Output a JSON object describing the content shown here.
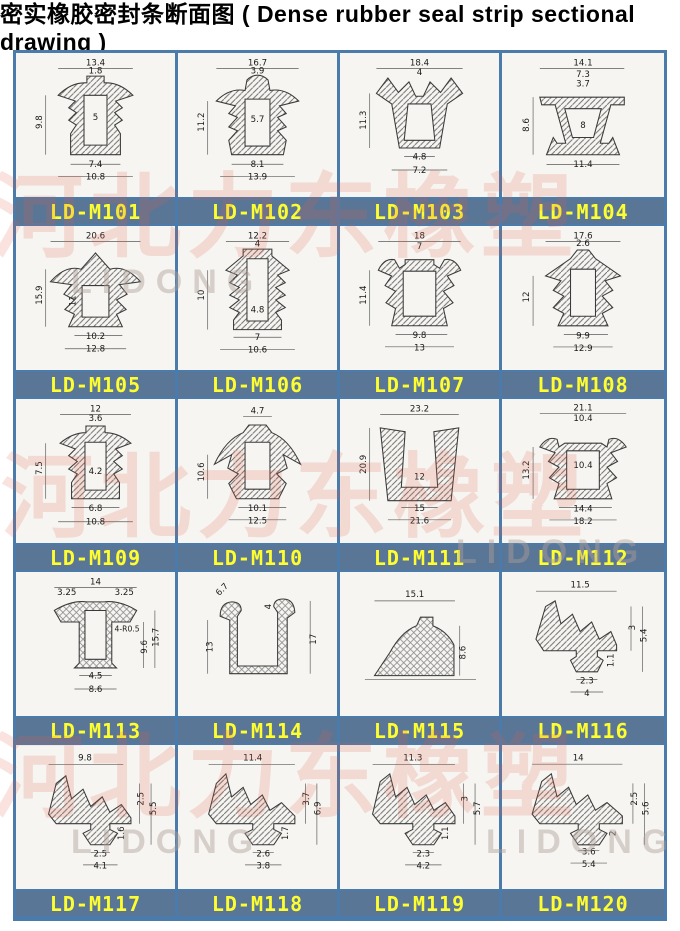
{
  "title": {
    "full": "密实橡胶密封条断面图 ( Dense rubber seal strip sectional drawing )",
    "zh": "密实橡胶密封条断面图",
    "en": "( Dense rubber seal strip sectional drawing )"
  },
  "watermark": {
    "zh": "河北力东橡塑",
    "en": "LIDONG"
  },
  "colors": {
    "table_border": "#4a7bab",
    "label_bar_bg": "#5a7696",
    "label_text": "#fdfd30",
    "paper": "#f6f5f1",
    "drawing_line": "#3a3a3a",
    "watermark_red": "rgba(228,94,74,0.18)"
  },
  "cells": [
    {
      "label": "LD-M101",
      "dims": [
        "13.4",
        "1.8",
        "9.8",
        "5",
        "7.4",
        "10.8"
      ]
    },
    {
      "label": "LD-M102",
      "dims": [
        "16.7",
        "3.9",
        "11.2",
        "5.7",
        "8.1",
        "13.9"
      ]
    },
    {
      "label": "LD-M103",
      "dims": [
        "18.4",
        "4",
        "11.3",
        "4.8",
        "7.2"
      ]
    },
    {
      "label": "LD-M104",
      "dims": [
        "14.1",
        "7.3",
        "3.7",
        "8.6",
        "8",
        "11.4"
      ]
    },
    {
      "label": "LD-M105",
      "dims": [
        "20.6",
        "15.9",
        "11",
        "10.2",
        "12.8"
      ]
    },
    {
      "label": "LD-M106",
      "dims": [
        "12.2",
        "4",
        "10",
        "4.8",
        "7",
        "10.6"
      ]
    },
    {
      "label": "LD-M107",
      "dims": [
        "18",
        "7",
        "11.4",
        "9.8",
        "13"
      ]
    },
    {
      "label": "LD-M108",
      "dims": [
        "17.6",
        "2.6",
        "12",
        "9.9",
        "12.9"
      ]
    },
    {
      "label": "LD-M109",
      "dims": [
        "12",
        "3.6",
        "7.5",
        "4.2",
        "6.8",
        "10.8"
      ]
    },
    {
      "label": "LD-M110",
      "dims": [
        "4.7",
        "10.6",
        "10.1",
        "12.5"
      ]
    },
    {
      "label": "LD-M111",
      "dims": [
        "23.2",
        "20.9",
        "12",
        "15",
        "21.6"
      ]
    },
    {
      "label": "LD-M112",
      "dims": [
        "21.1",
        "10.4",
        "13.2",
        "10.4",
        "14.4",
        "18.2"
      ]
    },
    {
      "label": "LD-M113",
      "dims": [
        "14",
        "3.25",
        "3.25",
        "15.7",
        "4-R0.5",
        "9.6",
        "4.5",
        "8.6"
      ]
    },
    {
      "label": "LD-M114",
      "dims": [
        "6.7",
        "4",
        "13",
        "17"
      ]
    },
    {
      "label": "LD-M115",
      "dims": [
        "15.1",
        "8.6"
      ]
    },
    {
      "label": "LD-M116",
      "dims": [
        "11.5",
        "3",
        "5.4",
        "1.1",
        "2.3",
        "4"
      ]
    },
    {
      "label": "LD-M117",
      "dims": [
        "9.8",
        "2.5",
        "5.5",
        "1.6",
        "2.5",
        "4.1"
      ]
    },
    {
      "label": "LD-M118",
      "dims": [
        "11.4",
        "3.7",
        "6.9",
        "1.7",
        "2.6",
        "3.8"
      ]
    },
    {
      "label": "LD-M119",
      "dims": [
        "11.3",
        "3",
        "5.7",
        "1.1",
        "2.3",
        "4.2"
      ]
    },
    {
      "label": "LD-M120",
      "dims": [
        "14",
        "2.5",
        "5.6",
        "2",
        "3.6",
        "5.4"
      ]
    }
  ]
}
